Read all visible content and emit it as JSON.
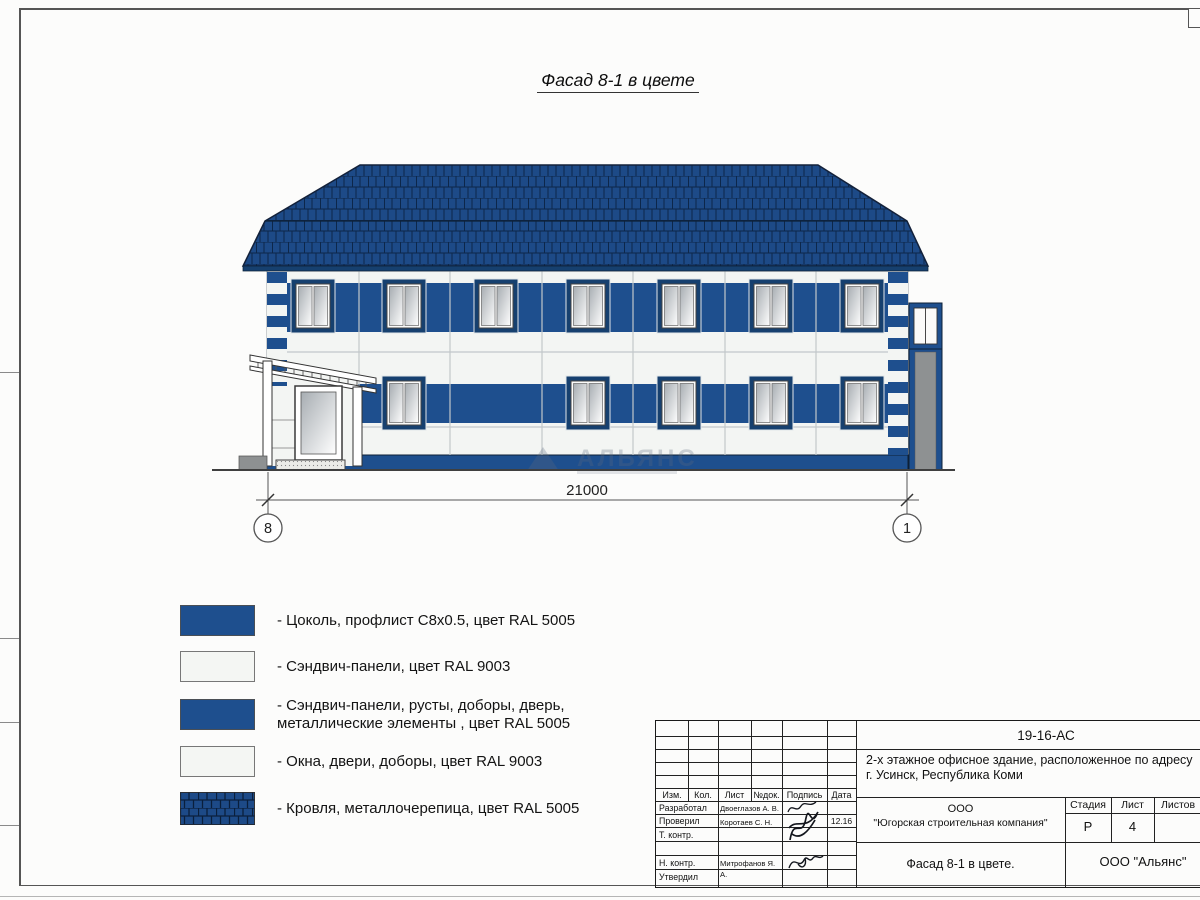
{
  "page": {
    "title": "Фасад 8-1 в цвете"
  },
  "drawing": {
    "dimension_label": "21000",
    "axis_left": "8",
    "axis_right": "1",
    "watermark_text": "АЛЬЯНС"
  },
  "legend": {
    "items": [
      {
        "swatch": "solid-blue",
        "label": "- Цоколь, профлист С8х0.5, цвет RAL 5005"
      },
      {
        "swatch": "solid-white",
        "label": "- Сэндвич-панели, цвет RAL 9003"
      },
      {
        "swatch": "solid-blue",
        "label": "- Сэндвич-панели, русты, доборы, дверь,\nметаллические элементы , цвет RAL 5005"
      },
      {
        "swatch": "solid-white",
        "label": "- Окна, двери, доборы, цвет RAL 9003"
      },
      {
        "swatch": "roof-tiles",
        "label": "- Кровля, металлочерепица, цвет RAL 5005"
      }
    ]
  },
  "titleblock": {
    "doc_code": "19-16-АС",
    "project_line1": "2-х этажное офисное здание, расположенное по адресу",
    "project_line2": "г. Усинск, Республика Коми",
    "header": {
      "izm": "Изм.",
      "kol": "Кол.",
      "list": "Лист",
      "ndok": "№док.",
      "podpis": "Подпись",
      "data": "Дата"
    },
    "rows": [
      {
        "role": "Разработал",
        "name": "Двоеглазов А. В.",
        "date": ""
      },
      {
        "role": "Проверил",
        "name": "Коротаев С. Н.",
        "date": "12.16"
      },
      {
        "role": "Т. контр.",
        "name": "",
        "date": ""
      },
      {
        "role": "",
        "name": "",
        "date": ""
      },
      {
        "role": "Н. контр.",
        "name": "Митрофанов Я. А.",
        "date": ""
      },
      {
        "role": "Утвердил",
        "name": "",
        "date": ""
      }
    ],
    "company_line1": "ООО",
    "company_line2": "\"Югорская строительная компания\"",
    "stage_label": "Стадия",
    "sheet_label": "Лист",
    "sheets_label": "Листов",
    "stage_value": "Р",
    "sheet_value": "4",
    "sheets_value": "",
    "sheet_title": "Фасад 8-1 в цвете.",
    "org": "ООО \"Альянс\""
  },
  "colors": {
    "ral5005_blue": "#1E4F8E",
    "roof_blue": "#1D4A87",
    "ral9003_white": "#F4F6F3",
    "tile_line": "#0B2444",
    "window_frame_blue": "#16406F"
  }
}
